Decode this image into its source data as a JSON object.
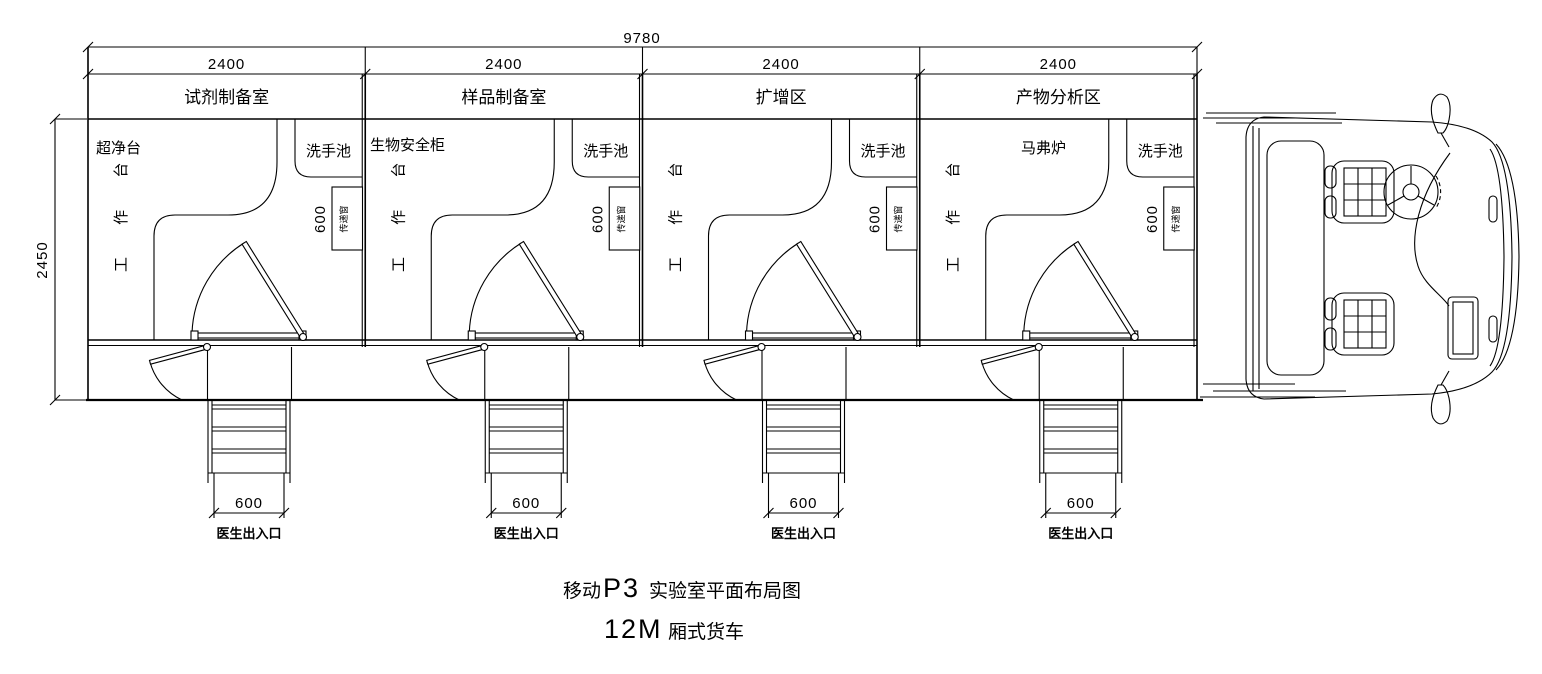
{
  "dims": {
    "overall": "9780",
    "module": "2400",
    "depth": "2450",
    "pass_window": "600",
    "stair": "600"
  },
  "labels": {
    "sink": "洗手池",
    "bench": "工 作 台",
    "pass_window": "传递窗",
    "exit": "医生出入口"
  },
  "rooms": [
    {
      "name": "试剂制备室",
      "appliance": "超净台"
    },
    {
      "name": "样品制备室",
      "appliance": "生物安全柜"
    },
    {
      "name": "扩增区",
      "appliance": ""
    },
    {
      "name": "产物分析区",
      "appliance": "马弗炉"
    }
  ],
  "title": {
    "pre": "移动",
    "latin": "P3",
    "post": "实验室平面布局图"
  },
  "subtitle": {
    "latin": "12M",
    "post": "厢式货车"
  }
}
